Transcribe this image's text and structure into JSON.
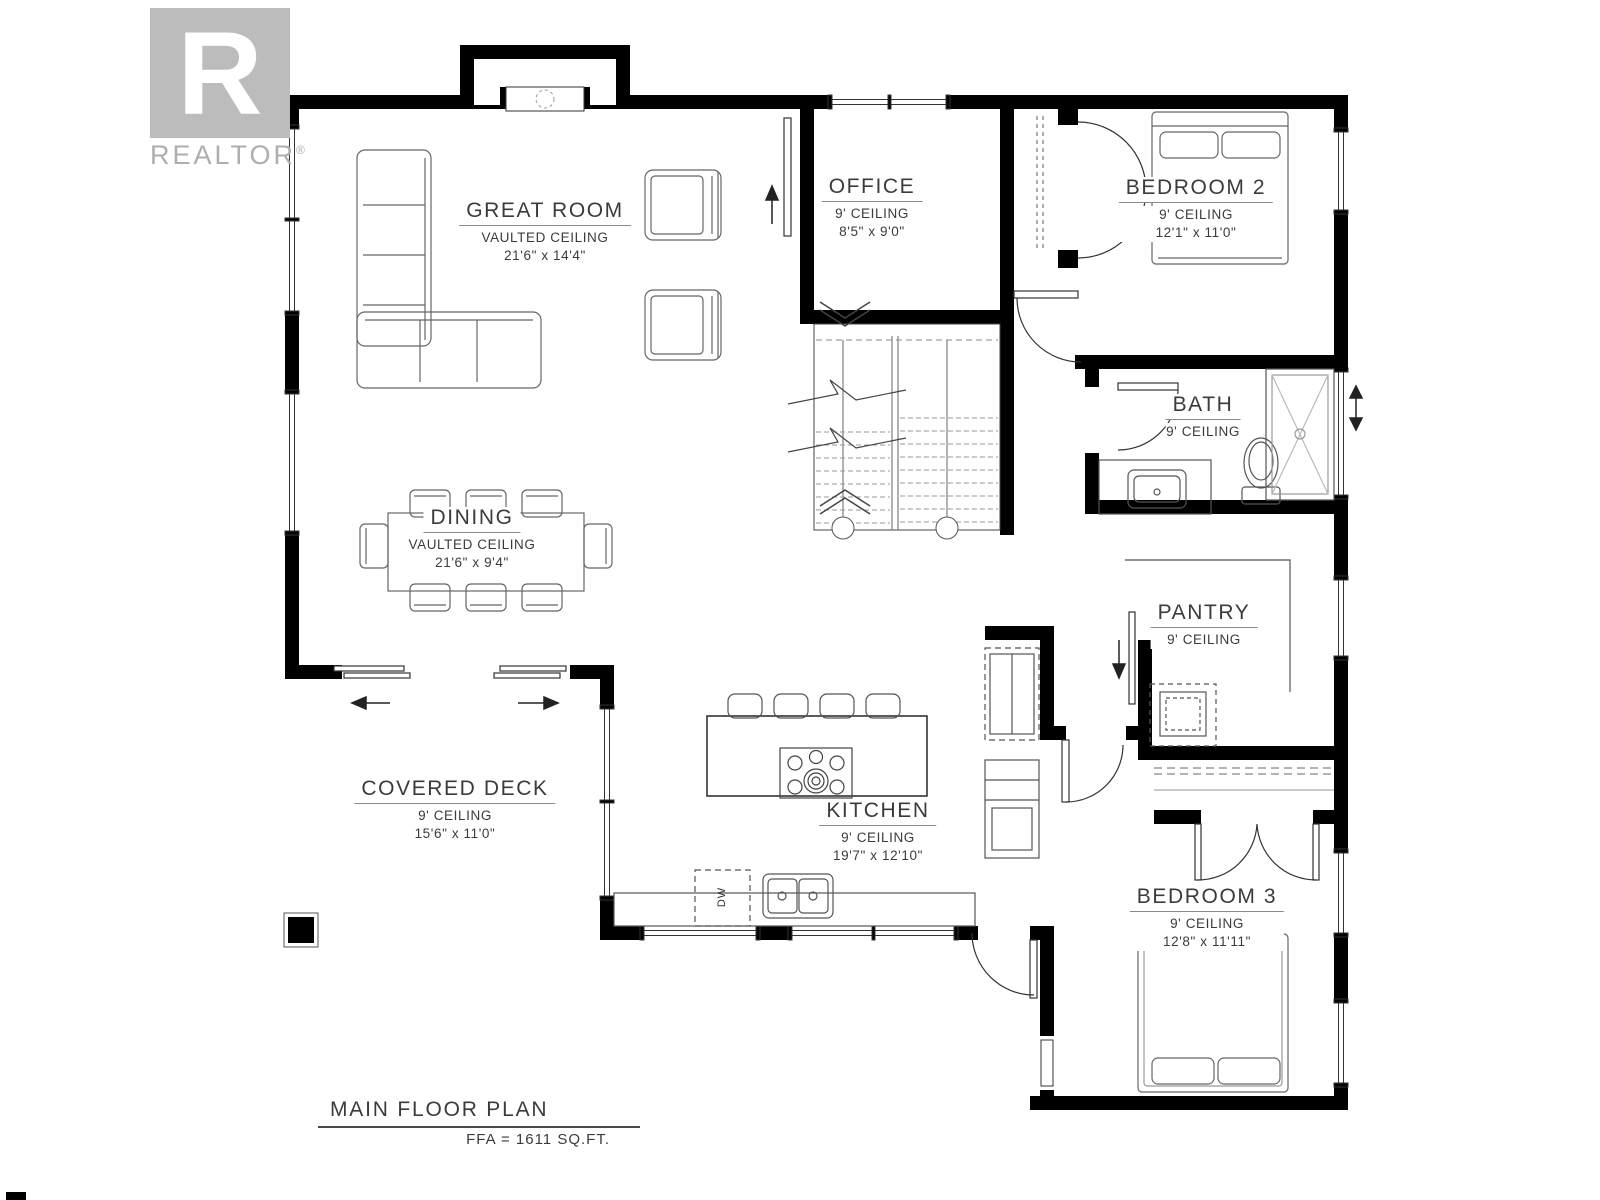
{
  "branding": {
    "brand_name": "REALTOR",
    "registered_mark": "®",
    "logo_letter": "R"
  },
  "plan": {
    "title": "MAIN FLOOR PLAN",
    "area_note": "FFA = 1611 SQ.FT."
  },
  "rooms": [
    {
      "id": "great-room",
      "name": "GREAT ROOM",
      "ceiling": "VAULTED CEILING",
      "dimensions": "21'6\" x 14'4\""
    },
    {
      "id": "office",
      "name": "OFFICE",
      "ceiling": "9' CEILING",
      "dimensions": "8'5\" x 9'0\""
    },
    {
      "id": "bedroom-2",
      "name": "BEDROOM 2",
      "ceiling": "9' CEILING",
      "dimensions": "12'1\" x 11'0\""
    },
    {
      "id": "bath",
      "name": "BATH",
      "ceiling": "9' CEILING",
      "dimensions": ""
    },
    {
      "id": "dining",
      "name": "DINING",
      "ceiling": "VAULTED CEILING",
      "dimensions": "21'6\" x 9'4\""
    },
    {
      "id": "pantry",
      "name": "PANTRY",
      "ceiling": "9' CEILING",
      "dimensions": ""
    },
    {
      "id": "covered-deck",
      "name": "COVERED DECK",
      "ceiling": "9' CEILING",
      "dimensions": "15'6\" x 11'0\""
    },
    {
      "id": "kitchen",
      "name": "KITCHEN",
      "ceiling": "9' CEILING",
      "dimensions": "19'7\" x 12'10\""
    },
    {
      "id": "bedroom-3",
      "name": "BEDROOM 3",
      "ceiling": "9' CEILING",
      "dimensions": "12'8\" x 11'11\""
    }
  ],
  "fixtures": {
    "dishwasher_label": "DW"
  },
  "colors": {
    "wall": "#000000",
    "logo_gray": "#bcbcbc",
    "text": "#3b3b3b"
  }
}
